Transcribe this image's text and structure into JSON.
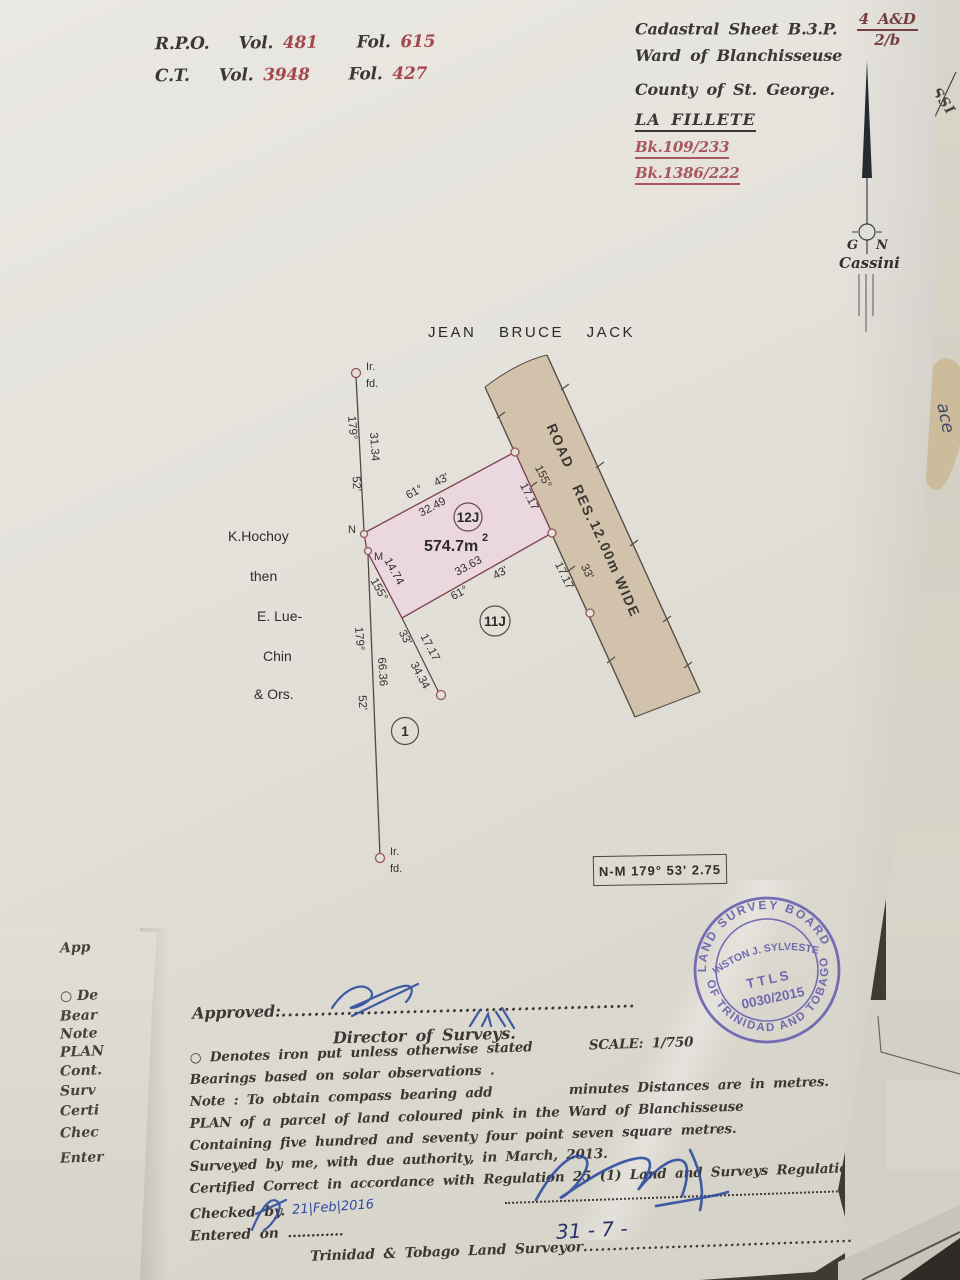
{
  "colors": {
    "accent_red": "#a5484e",
    "bk_red": "#a9565e",
    "stamp_purple": "#5f55ad",
    "parcel_pink": "#ead6e0",
    "road_tan": "#d2c2ab",
    "ink": "#3b3834",
    "pen_blue": "#2e4da0"
  },
  "refs": {
    "rpo_label": "R.P.O.",
    "rpo_vol_label": "Vol.",
    "rpo_vol": "481",
    "rpo_fol_label": "Fol.",
    "rpo_fol": "615",
    "ct_label": "C.T.",
    "ct_vol_label": "Vol.",
    "ct_vol": "3948",
    "ct_fol_label": "Fol.",
    "ct_fol": "427"
  },
  "header": {
    "cadastral_label": "Cadastral Sheet B.3.P.",
    "cadastral_num": "4 A&D",
    "cadastral_den": "2/b",
    "ward": "Ward of Blanchisseuse",
    "county": "County of St. George.",
    "place": "LA FILLETE",
    "bk1": "Bk.109/233",
    "bk2": "Bk.1386/222"
  },
  "north": {
    "g": "G",
    "n": "N",
    "system": "Cassini"
  },
  "plan": {
    "owner_top": "JEAN  BRUCE  JACK",
    "adjoiner": [
      "K.Hochoy",
      "then",
      "E. Lue-",
      "Chin",
      "& Ors."
    ],
    "parcel_label": "12J",
    "area": "574.7m",
    "area_sup": "2",
    "parcel_below": "11J",
    "lot1": "1",
    "road": [
      "ROAD",
      "RES.",
      "12.00m",
      "WIDE"
    ],
    "nm_box": "N-M 179°  53'   2.75",
    "dims": [
      {
        "t": "61°"
      },
      {
        "t": "43'"
      },
      {
        "t": "32.49"
      },
      {
        "t": "155°"
      },
      {
        "t": "17.17"
      },
      {
        "t": "33.63"
      },
      {
        "t": "61°"
      },
      {
        "t": "43'"
      },
      {
        "t": "14.74"
      },
      {
        "t": "155°"
      },
      {
        "t": "17.17"
      },
      {
        "t": "33'"
      },
      {
        "t": "33'"
      },
      {
        "t": "17.17"
      },
      {
        "t": "34.34"
      },
      {
        "t": "179°"
      },
      {
        "t": "31.34"
      },
      {
        "t": "52'"
      },
      {
        "t": "179°"
      },
      {
        "t": "66.36"
      },
      {
        "t": "52'"
      }
    ],
    "marks": [
      {
        "t": "Ir."
      },
      {
        "t": "fd."
      },
      {
        "t": "Ir."
      },
      {
        "t": "fd."
      },
      {
        "t": "N"
      },
      {
        "t": "M"
      }
    ]
  },
  "stamp": {
    "arc_top": "LAND SURVEY BOARD",
    "arc_bottom": "OF TRINIDAD AND TOBAGO",
    "name": "WINSTON J. SYLVESTER",
    "title": "TTLS",
    "number": "0030/2015"
  },
  "approval": {
    "label": "Approved:",
    "dots": "......................................................",
    "director": "Director  of  Surveys."
  },
  "notes": {
    "n1a": "○ Denotes iron put unless otherwise stated",
    "n1b": "SCALE:   1/750",
    "n2": "Bearings based on solar observations .",
    "n3a": "Note : To obtain compass bearing add",
    "n3b": "minutes   Distances are in metres.",
    "n4": "PLAN of a parcel of land coloured  pink  in   the Ward of Blanchisseuse",
    "n5": "Containing five hundred and seventy four point seven square metres.",
    "n6": "Surveyed by me, with due authority, in March, 2013.",
    "n7": "Certified Correct in accordance with Regulation 25 (1) Land and Surveys Regulation 1998."
  },
  "footer": {
    "checked_label": "Checked by.",
    "checked_date": "21|Feb|2016",
    "entered": "Entered on ............",
    "surveyor_label": "Trinidad & Tobago Land Surveyor",
    "surveyor_dots": "....................................................",
    "surveyor_year": "2015",
    "hand_date": "31  -  7 -"
  },
  "under_left_lines": [
    "App",
    "○ De",
    "Bear",
    "Note",
    "PLAN",
    "Cont.",
    "Surv",
    "Certi",
    "Chec",
    "Enter"
  ],
  "fragments": {
    "right_top": "G.SSI",
    "right_mid": "ace"
  }
}
